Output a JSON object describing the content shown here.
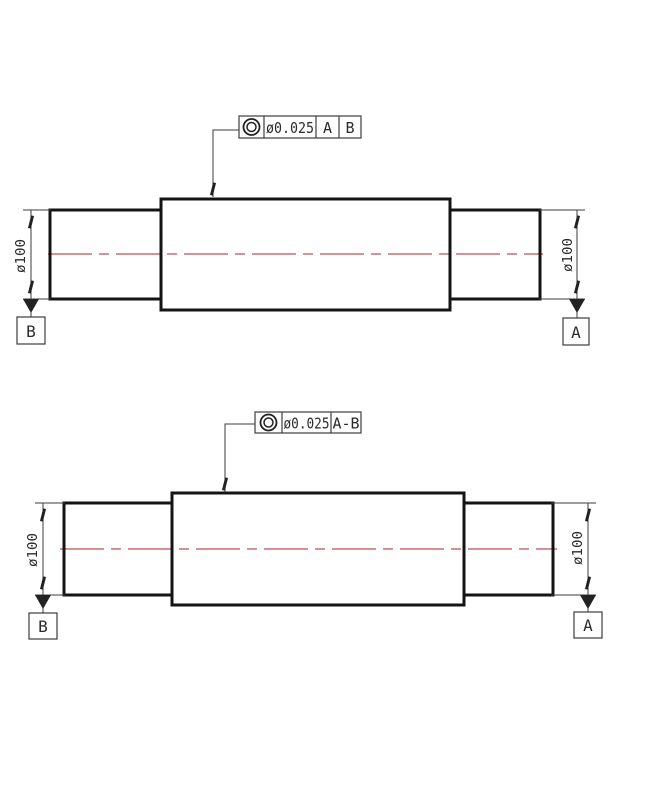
{
  "title": "shaft-concentricity-tolerance-drawing",
  "colors": {
    "outline": "#141414",
    "thin_line": "#3d3d3d",
    "centerline": "#c04f4f",
    "text": "#2b2b2b"
  },
  "drawing_top": {
    "fcf": {
      "symbol_icon": "concentricity-icon",
      "tolerance": "ø0.025",
      "datum_ref_1": "A",
      "datum_ref_2": "B"
    },
    "dim_left": "ø100",
    "dim_right": "ø100",
    "datum_box_left": "B",
    "datum_box_right": "A"
  },
  "drawing_bottom": {
    "fcf": {
      "symbol_icon": "concentricity-icon",
      "tolerance": "ø0.025",
      "datum_ref_1": "A-B"
    },
    "dim_left": "ø100",
    "dim_right": "ø100",
    "datum_box_left": "B",
    "datum_box_right": "A"
  }
}
